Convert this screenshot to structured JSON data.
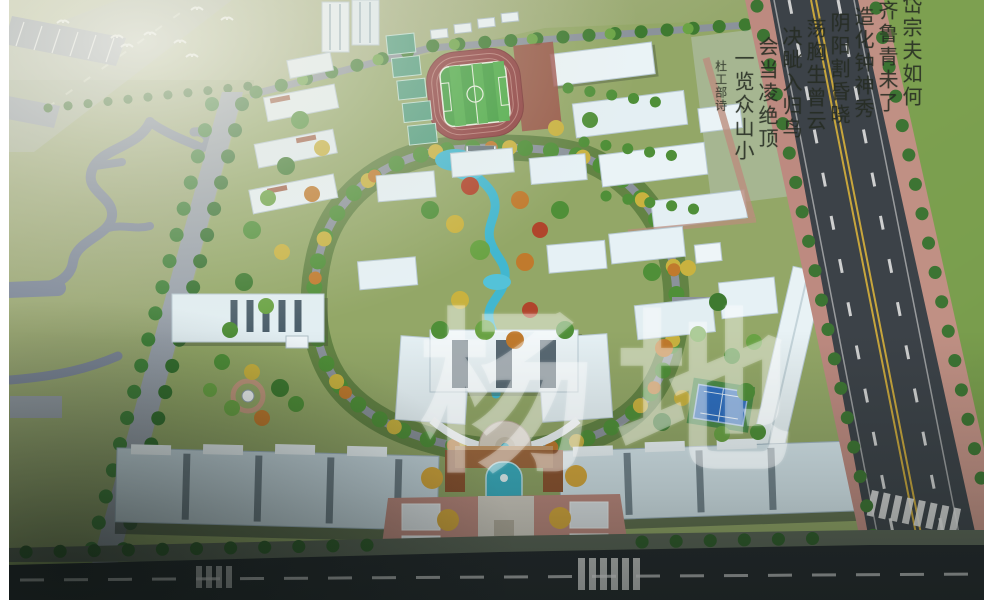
{
  "watermark": {
    "text": "杨地",
    "color": "#ffffff",
    "opacity": "30%"
  },
  "calligraphy": {
    "columns": [
      "岱宗夫如何",
      "齐鲁青未了",
      "造化钟神秀",
      "阴阳割昏晓",
      "荡胸生曾云",
      "决眦入归鸟",
      "会当凌绝顶",
      "一览众山小"
    ],
    "signature": "杜工部诗",
    "ink_color": "#262c22"
  },
  "scene": {
    "type": "aerial-masterplan-rendering",
    "features": [
      {
        "name": "running-track",
        "color": "#8e4040"
      },
      {
        "name": "soccer-field",
        "color": "#3f9d3d"
      },
      {
        "name": "sports-courts",
        "color": "#4e9c7d"
      },
      {
        "name": "tennis-court",
        "color": "#2e6ec0"
      },
      {
        "name": "water-garden",
        "color": "#42b7cf"
      },
      {
        "name": "buildings",
        "color": "#e6f1f5"
      },
      {
        "name": "arterial-road",
        "color": "#3c4248"
      },
      {
        "name": "road-sidewalk",
        "color": "#bd8a80"
      },
      {
        "name": "bottom-road",
        "color": "#23282c"
      },
      {
        "name": "field-green",
        "color": "#7d9a52"
      },
      {
        "name": "tree-green",
        "color": "#4f8f38"
      },
      {
        "name": "tree-yellow",
        "color": "#c9b23f"
      },
      {
        "name": "tree-orange",
        "color": "#c07a2d"
      },
      {
        "name": "tree-red",
        "color": "#b0452c"
      },
      {
        "name": "entrance-gate",
        "color": "#a2693e"
      },
      {
        "name": "entrance-plaza",
        "color": "#bf8a7f"
      },
      {
        "name": "center-line-yellow",
        "color": "#c8a63c"
      }
    ]
  }
}
